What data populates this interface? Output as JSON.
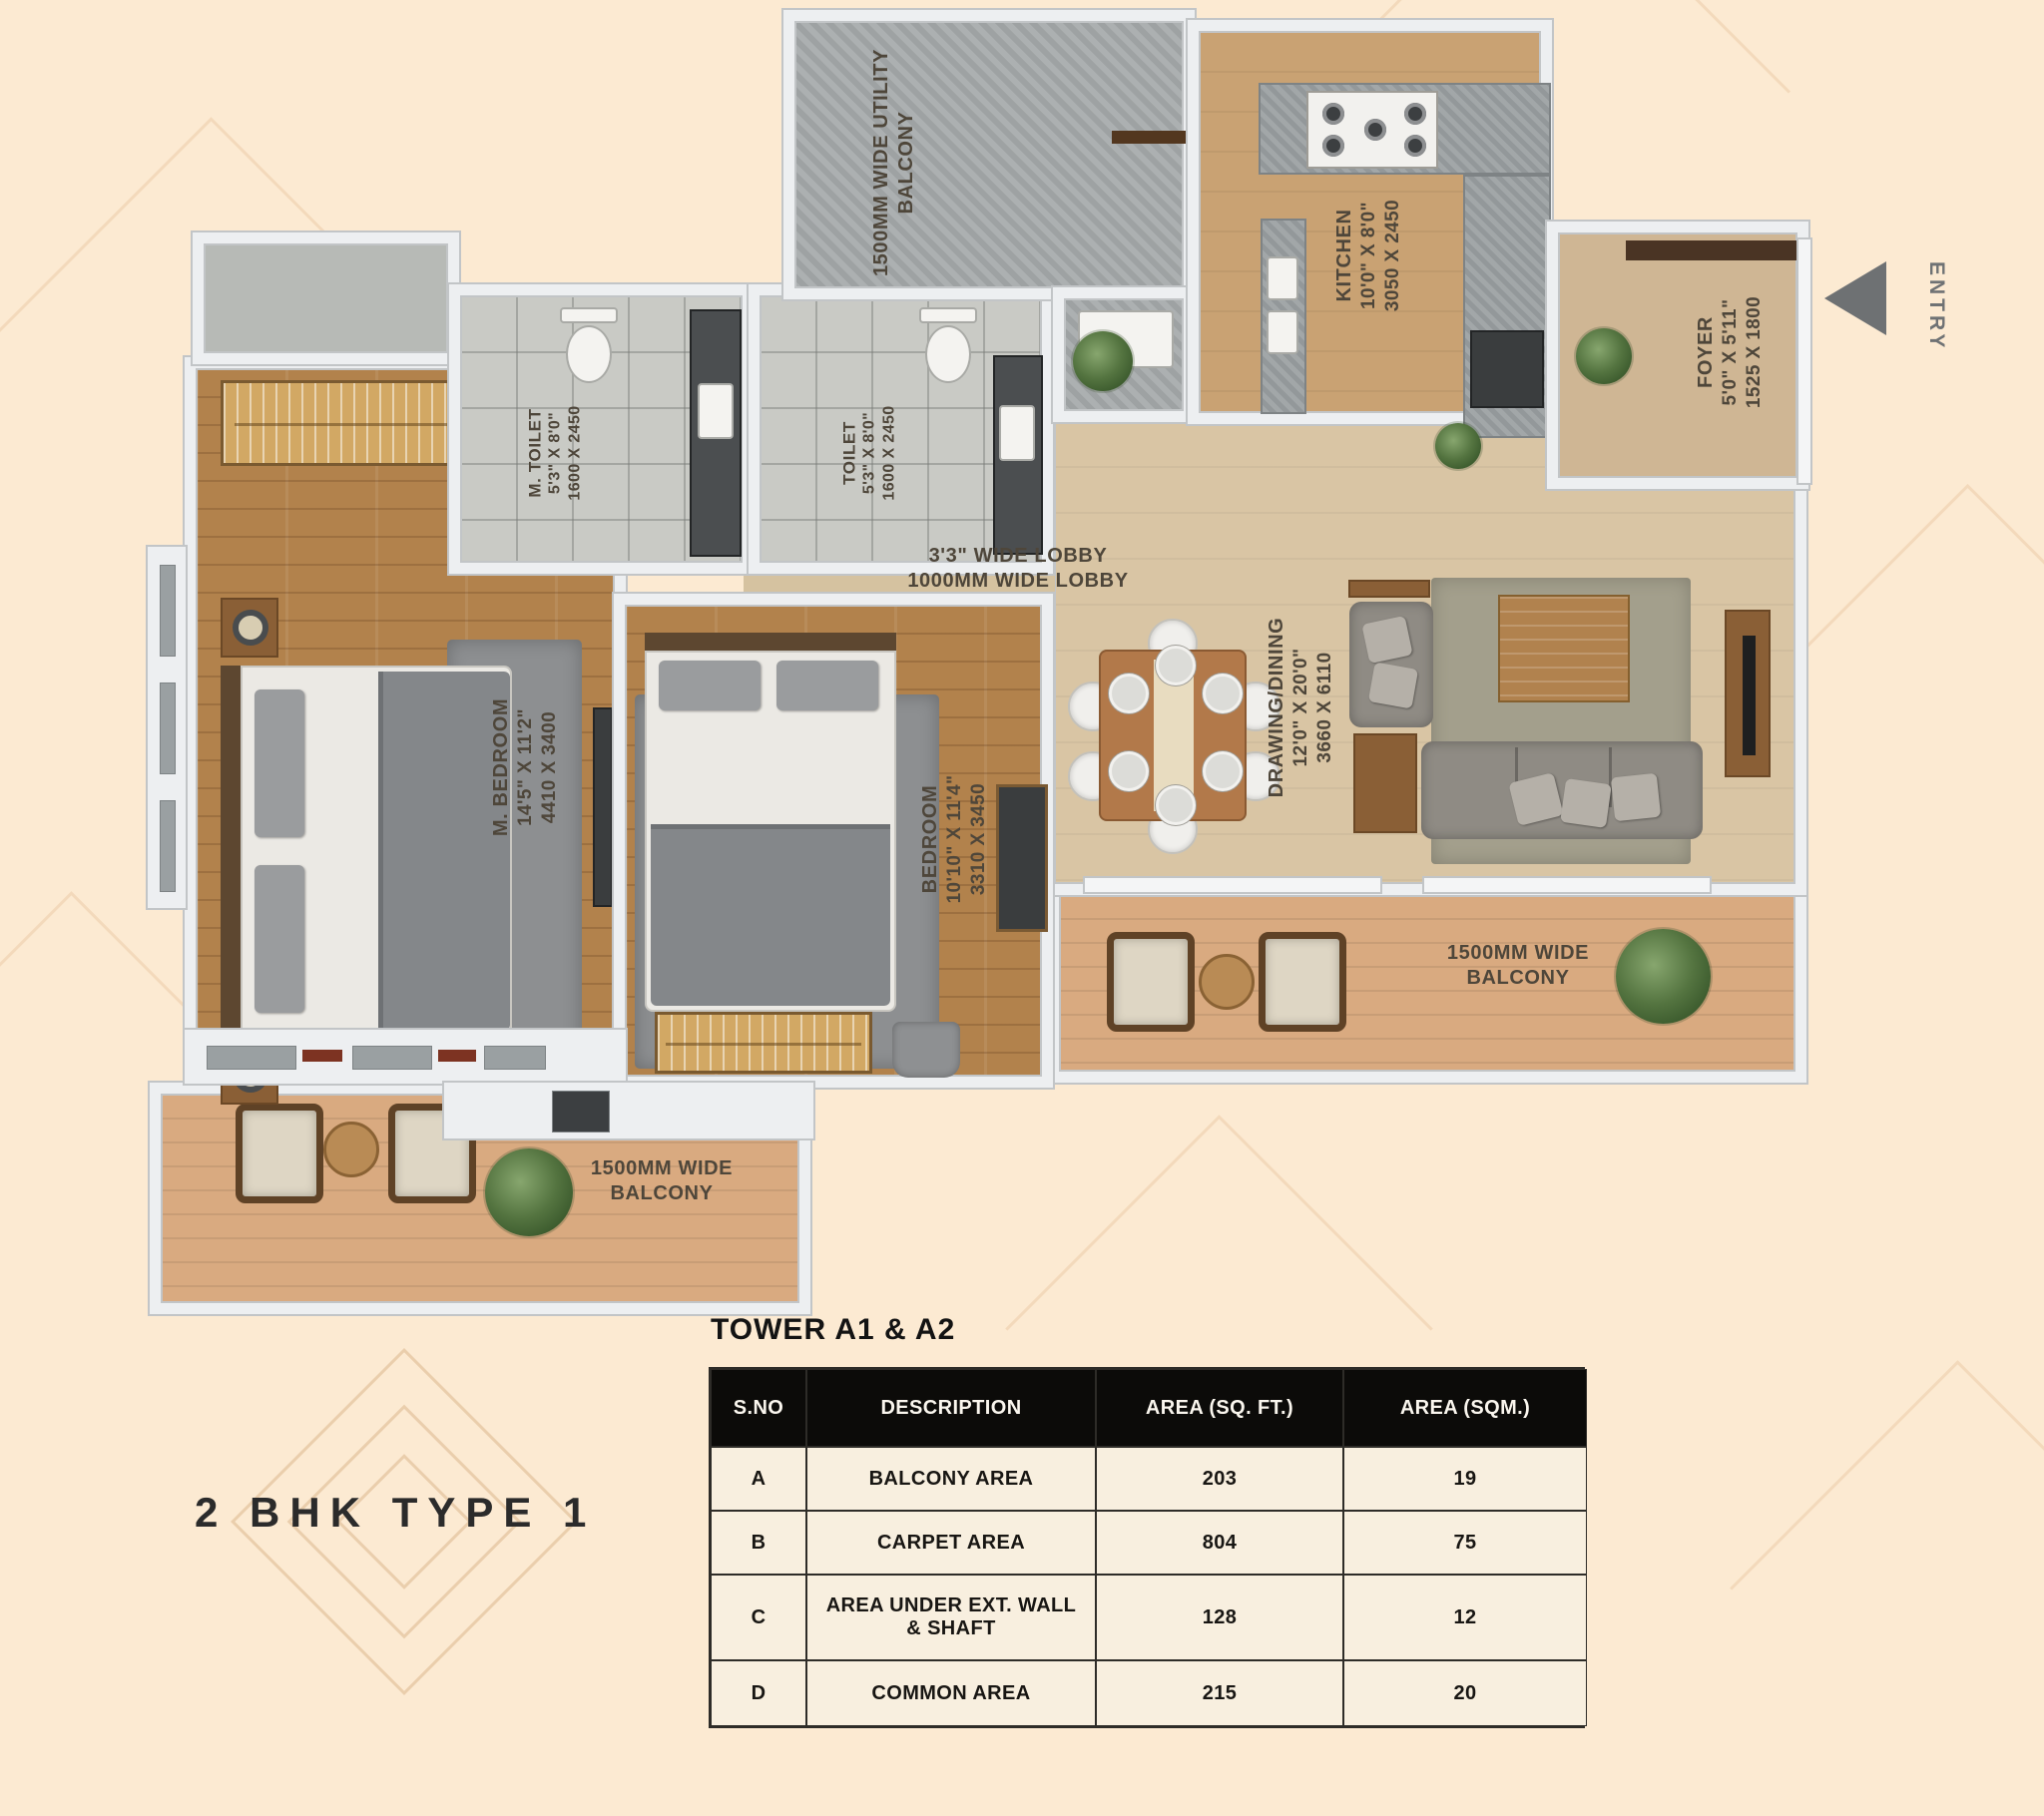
{
  "plan_title": "2 BHK TYPE 1",
  "entry_label": "ENTRY",
  "rooms": {
    "utility_balcony": {
      "line1": "1500MM WIDE UTILITY",
      "line2": "BALCONY"
    },
    "kitchen": {
      "name": "KITCHEN",
      "dim_ft": "10'0\" X 8'0\"",
      "dim_mm": "3050 X 2450"
    },
    "foyer": {
      "name": "FOYER",
      "dim_ft": "5'0\" X 5'11\"",
      "dim_mm": "1525 X 1800"
    },
    "m_toilet": {
      "name": "M. TOILET",
      "dim_ft": "5'3\" X 8'0\"",
      "dim_mm": "1600 X 2450"
    },
    "toilet": {
      "name": "TOILET",
      "dim_ft": "5'3\" X 8'0\"",
      "dim_mm": "1600 X 2450"
    },
    "lobby": {
      "line1": "3'3\" WIDE LOBBY",
      "line2": "1000MM WIDE LOBBY"
    },
    "m_bedroom": {
      "name": "M. BEDROOM",
      "dim_ft": "14'5\" X 11'2\"",
      "dim_mm": "4410 X 3400"
    },
    "bedroom": {
      "name": "BEDROOM",
      "dim_ft": "10'10\" X 11'4\"",
      "dim_mm": "3310 X 3450"
    },
    "drawing_dining": {
      "name": "DRAWING/DINING",
      "dim_ft": "12'0\" X 20'0\"",
      "dim_mm": "3660 X 6110"
    },
    "balcony_right": {
      "line1": "1500MM WIDE",
      "line2": "BALCONY"
    },
    "balcony_left": {
      "line1": "1500MM WIDE",
      "line2": "BALCONY"
    }
  },
  "area_table": {
    "title": "TOWER A1 & A2",
    "headers": [
      "S.NO",
      "DESCRIPTION",
      "AREA (SQ. FT.)",
      "AREA (SQM.)"
    ],
    "rows": [
      {
        "sno": "A",
        "desc": "BALCONY AREA",
        "sqft": "203",
        "sqm": "19"
      },
      {
        "sno": "B",
        "desc": "CARPET AREA",
        "sqft": "804",
        "sqm": "75"
      },
      {
        "sno": "C",
        "desc": "AREA UNDER EXT. WALL & SHAFT",
        "sqft": "128",
        "sqm": "12"
      },
      {
        "sno": "D",
        "desc": "COMMON AREA",
        "sqft": "215",
        "sqm": "20"
      }
    ]
  },
  "colors": {
    "page_background": "#fcead2",
    "wall": "#edeff1",
    "wood_floor": "#b2824c",
    "tile_floor": "#c9cac5",
    "balcony_floor": "#d9aa80",
    "living_floor": "#d9c5a4",
    "label_text": "#4e463a",
    "table_header_bg": "#0c0b09",
    "table_row_bg": "#f8efdf"
  }
}
